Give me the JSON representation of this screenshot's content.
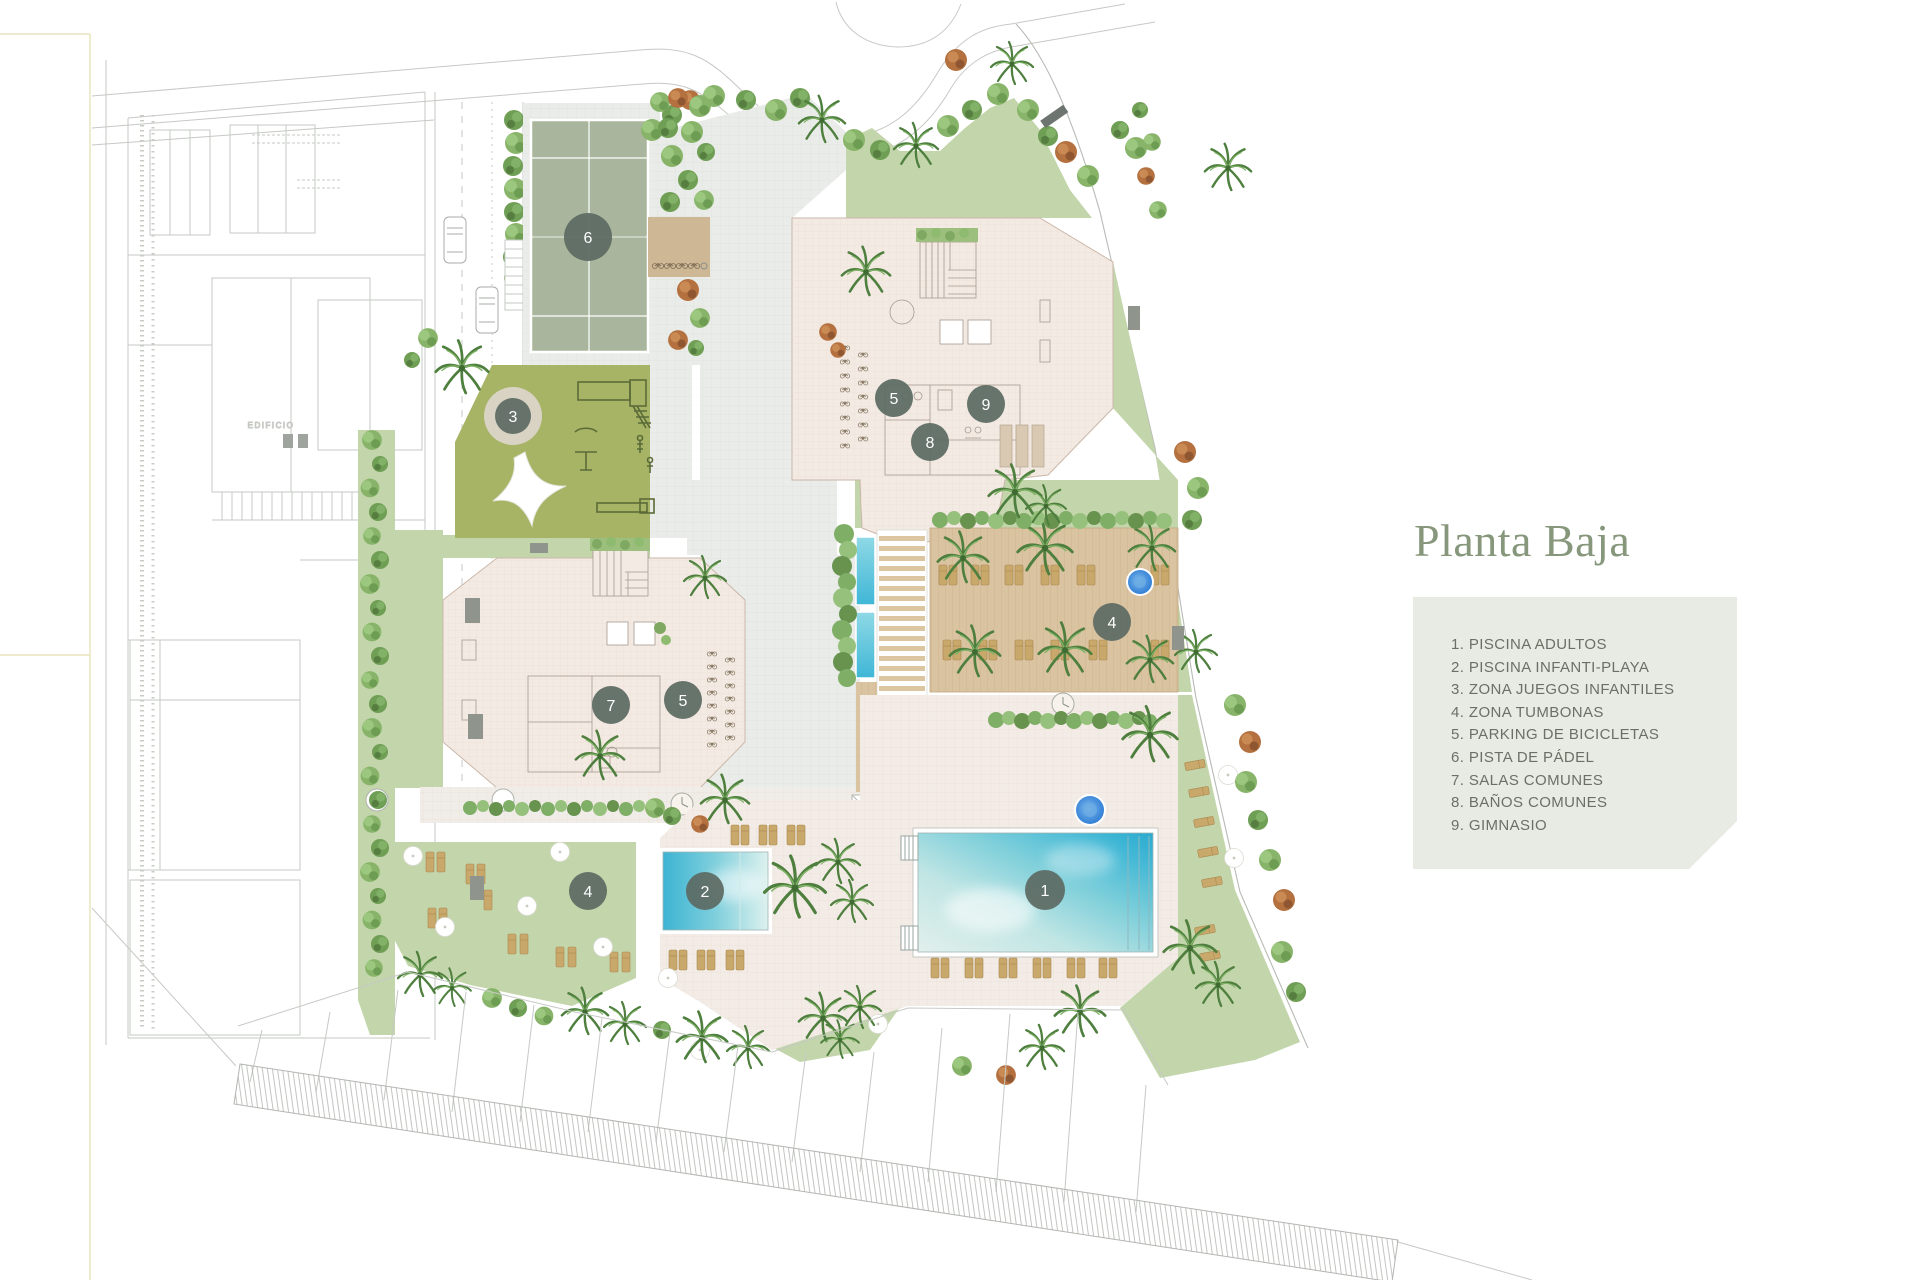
{
  "title": "Planta Baja",
  "legend": {
    "items": [
      "1. PISCINA ADULTOS",
      "2. PISCINA INFANTI-PLAYA",
      "3. ZONA JUEGOS INFANTILES",
      "4. ZONA TUMBONAS",
      "5. PARKING DE BICICLETAS",
      "6. PISTA DE PÁDEL",
      "7. SALAS COMUNES",
      "8. BAÑOS COMUNES",
      "9. GIMNASIO"
    ]
  },
  "plan": {
    "neighbor_label": "EDIFICIO",
    "markers": {
      "m1": "1",
      "m2": "2",
      "m3": "3",
      "m4a": "4",
      "m4b": "4",
      "m5a": "5",
      "m5b": "5",
      "m6": "6",
      "m7": "7",
      "m8": "8",
      "m9": "9"
    },
    "colors": {
      "title_green": "#87977c",
      "legend_bg": "#e8eae4",
      "legend_text": "#6b6f65",
      "lawn": "#c3d5aa",
      "playground": "#a7b465",
      "padel_court": "#a9b59c",
      "building": "#f2eae3",
      "wood_deck": "#d9c3a1",
      "pool_water": "#3db4d3",
      "spa_blue": "#2f7dd3",
      "marker_grey": "#5d6a63"
    }
  }
}
